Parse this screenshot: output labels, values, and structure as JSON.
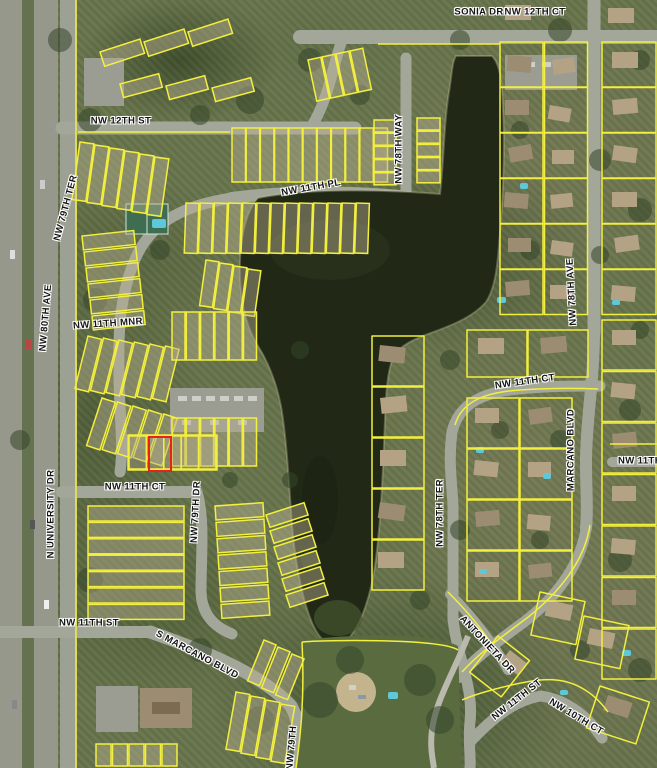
{
  "map": {
    "type": "aerial-parcel-map",
    "colors": {
      "parcel_line": "#f3ef3e",
      "selected_parcel_outline": "#e8221b",
      "water": "#242c1a",
      "road": "#a3a79a",
      "label_text": "#141414",
      "label_halo": "#ffffff",
      "vegetation": "#67744b",
      "pool": "#5fc8d8"
    },
    "selected_parcel": {
      "x": 148,
      "y": 436,
      "width": 20,
      "height": 32
    },
    "street_labels": [
      {
        "text": "SONIA DR",
        "x": 479,
        "y": 12,
        "rot": 0
      },
      {
        "text": "NW 12TH CT",
        "x": 535,
        "y": 12,
        "rot": 0
      },
      {
        "text": "NW 12TH ST",
        "x": 121,
        "y": 121,
        "rot": 0
      },
      {
        "text": "NW 78TH WAY",
        "x": 399,
        "y": 149,
        "rot": -90
      },
      {
        "text": "NW 11TH PL",
        "x": 311,
        "y": 188,
        "rot": -10
      },
      {
        "text": "NW 79TH TER",
        "x": 66,
        "y": 208,
        "rot": -75
      },
      {
        "text": "NW 80TH AVE",
        "x": 46,
        "y": 318,
        "rot": -85
      },
      {
        "text": "NW 11TH MNR",
        "x": 108,
        "y": 324,
        "rot": -4
      },
      {
        "text": "N UNIVERSITY DR",
        "x": 51,
        "y": 514,
        "rot": -90
      },
      {
        "text": "NW 11TH CT",
        "x": 135,
        "y": 487,
        "rot": 0
      },
      {
        "text": "NW 79TH DR",
        "x": 196,
        "y": 512,
        "rot": -87
      },
      {
        "text": "NW 11TH ST",
        "x": 89,
        "y": 623,
        "rot": 0
      },
      {
        "text": "S MARCANO BLVD",
        "x": 197,
        "y": 655,
        "rot": 28
      },
      {
        "text": "NW 78TH TER",
        "x": 440,
        "y": 513,
        "rot": -90
      },
      {
        "text": "MARCANO BLVD",
        "x": 571,
        "y": 450,
        "rot": -90
      },
      {
        "text": "NW 78TH AVE",
        "x": 572,
        "y": 292,
        "rot": -93
      },
      {
        "text": "NW 11TH CT",
        "x": 525,
        "y": 382,
        "rot": -8
      },
      {
        "text": "NW 11TH",
        "x": 640,
        "y": 461,
        "rot": 0
      },
      {
        "text": "ANTONIETA DR",
        "x": 487,
        "y": 645,
        "rot": 47
      },
      {
        "text": "NW 11TH ST",
        "x": 517,
        "y": 700,
        "rot": -38
      },
      {
        "text": "NW 10TH CT",
        "x": 576,
        "y": 717,
        "rot": 31
      },
      {
        "text": "NW 79TH",
        "x": 292,
        "y": 748,
        "rot": -85
      }
    ]
  }
}
